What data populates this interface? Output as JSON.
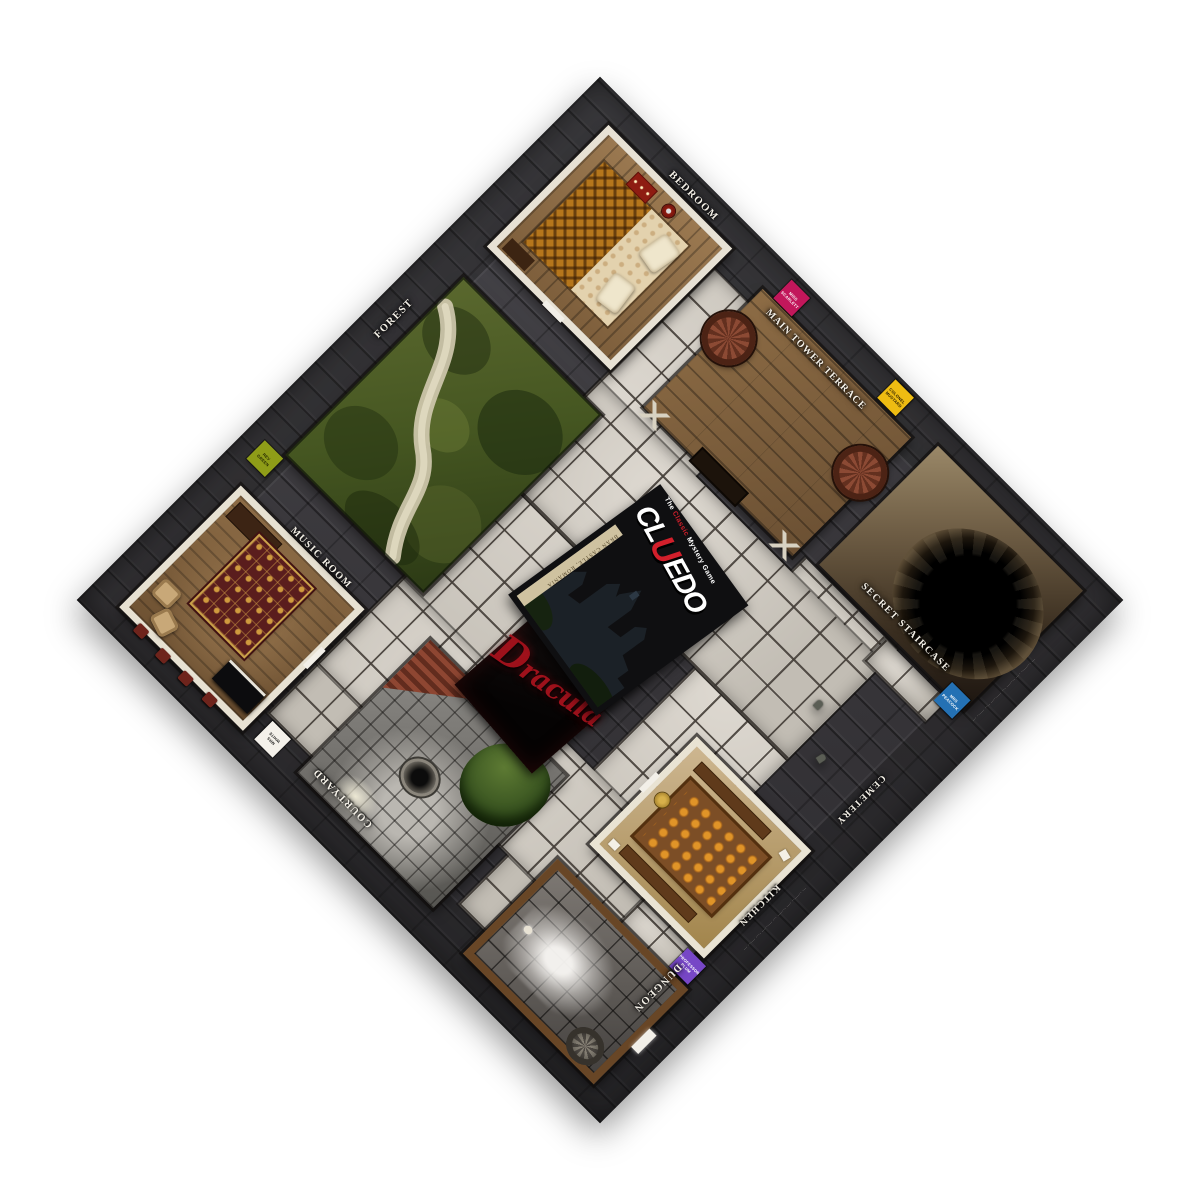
{
  "page": {
    "title": "Cluedo — Dracula edition game board (Bran Castle)"
  },
  "brand": {
    "tagline_pre": "The",
    "tagline_accent": "Classic",
    "tagline_post": "Mystery Game",
    "wordmark_pre": "CL",
    "wordmark_accent": "U",
    "wordmark_post": "EDO",
    "photo_caption": "BRAN CASTLE, ROMANIA",
    "accent_color": "#d21f2b"
  },
  "center_card": {
    "title": "Dracula",
    "title_color": "#9e111b"
  },
  "rooms": [
    {
      "id": "bedroom",
      "label": "BEDROOM"
    },
    {
      "id": "main-tower-terrace",
      "label": "MAIN TOWER TERRACE"
    },
    {
      "id": "secret-staircase",
      "label": "SECRET STAIRCASE"
    },
    {
      "id": "forest",
      "label": "FOREST"
    },
    {
      "id": "cemetery",
      "label": "CEMETERY"
    },
    {
      "id": "kitchen",
      "label": "KITCHEN"
    },
    {
      "id": "music-room",
      "label": "MUSIC ROOM"
    },
    {
      "id": "courtyard",
      "label": "COURTYARD"
    },
    {
      "id": "dungeon",
      "label": "DUNGEON"
    }
  ],
  "start_squares": [
    {
      "character": "MISS SCARLETT",
      "line1": "MISS",
      "line2": "SCARLETT",
      "color": "#c2175b",
      "text_color": "#ffffff"
    },
    {
      "character": "COLONEL MUSTARD",
      "line1": "COLONEL",
      "line2": "MUSTARD",
      "color": "#eebc12",
      "text_color": "#231800"
    },
    {
      "character": "MRS PEACOCK",
      "line1": "MRS",
      "line2": "PEACOCK",
      "color": "#2471b4",
      "text_color": "#ffffff"
    },
    {
      "character": "PROFESSOR PLUM",
      "line1": "PROFESSOR",
      "line2": "PLUM",
      "color": "#7747c6",
      "text_color": "#ffffff"
    },
    {
      "character": "REV GREEN",
      "line1": "REV",
      "line2": "GREEN",
      "color": "#8f9d18",
      "text_color": "#1d2000"
    },
    {
      "character": "MRS WHITE",
      "line1": "MRS",
      "line2": "WHITE",
      "color": "#f4f1ea",
      "text_color": "#2a2a28"
    }
  ],
  "microprint": {
    "credit": "··· ········ ···· ······· ··· ········· ···· ······ ···",
    "credit_short": "···· ········ ····"
  },
  "palette": {
    "stone_border": "#343336",
    "corridor_tile": "#ccc7bf",
    "wood_floor": "#8d6c46",
    "wall_trim": "#e7e1d4"
  }
}
